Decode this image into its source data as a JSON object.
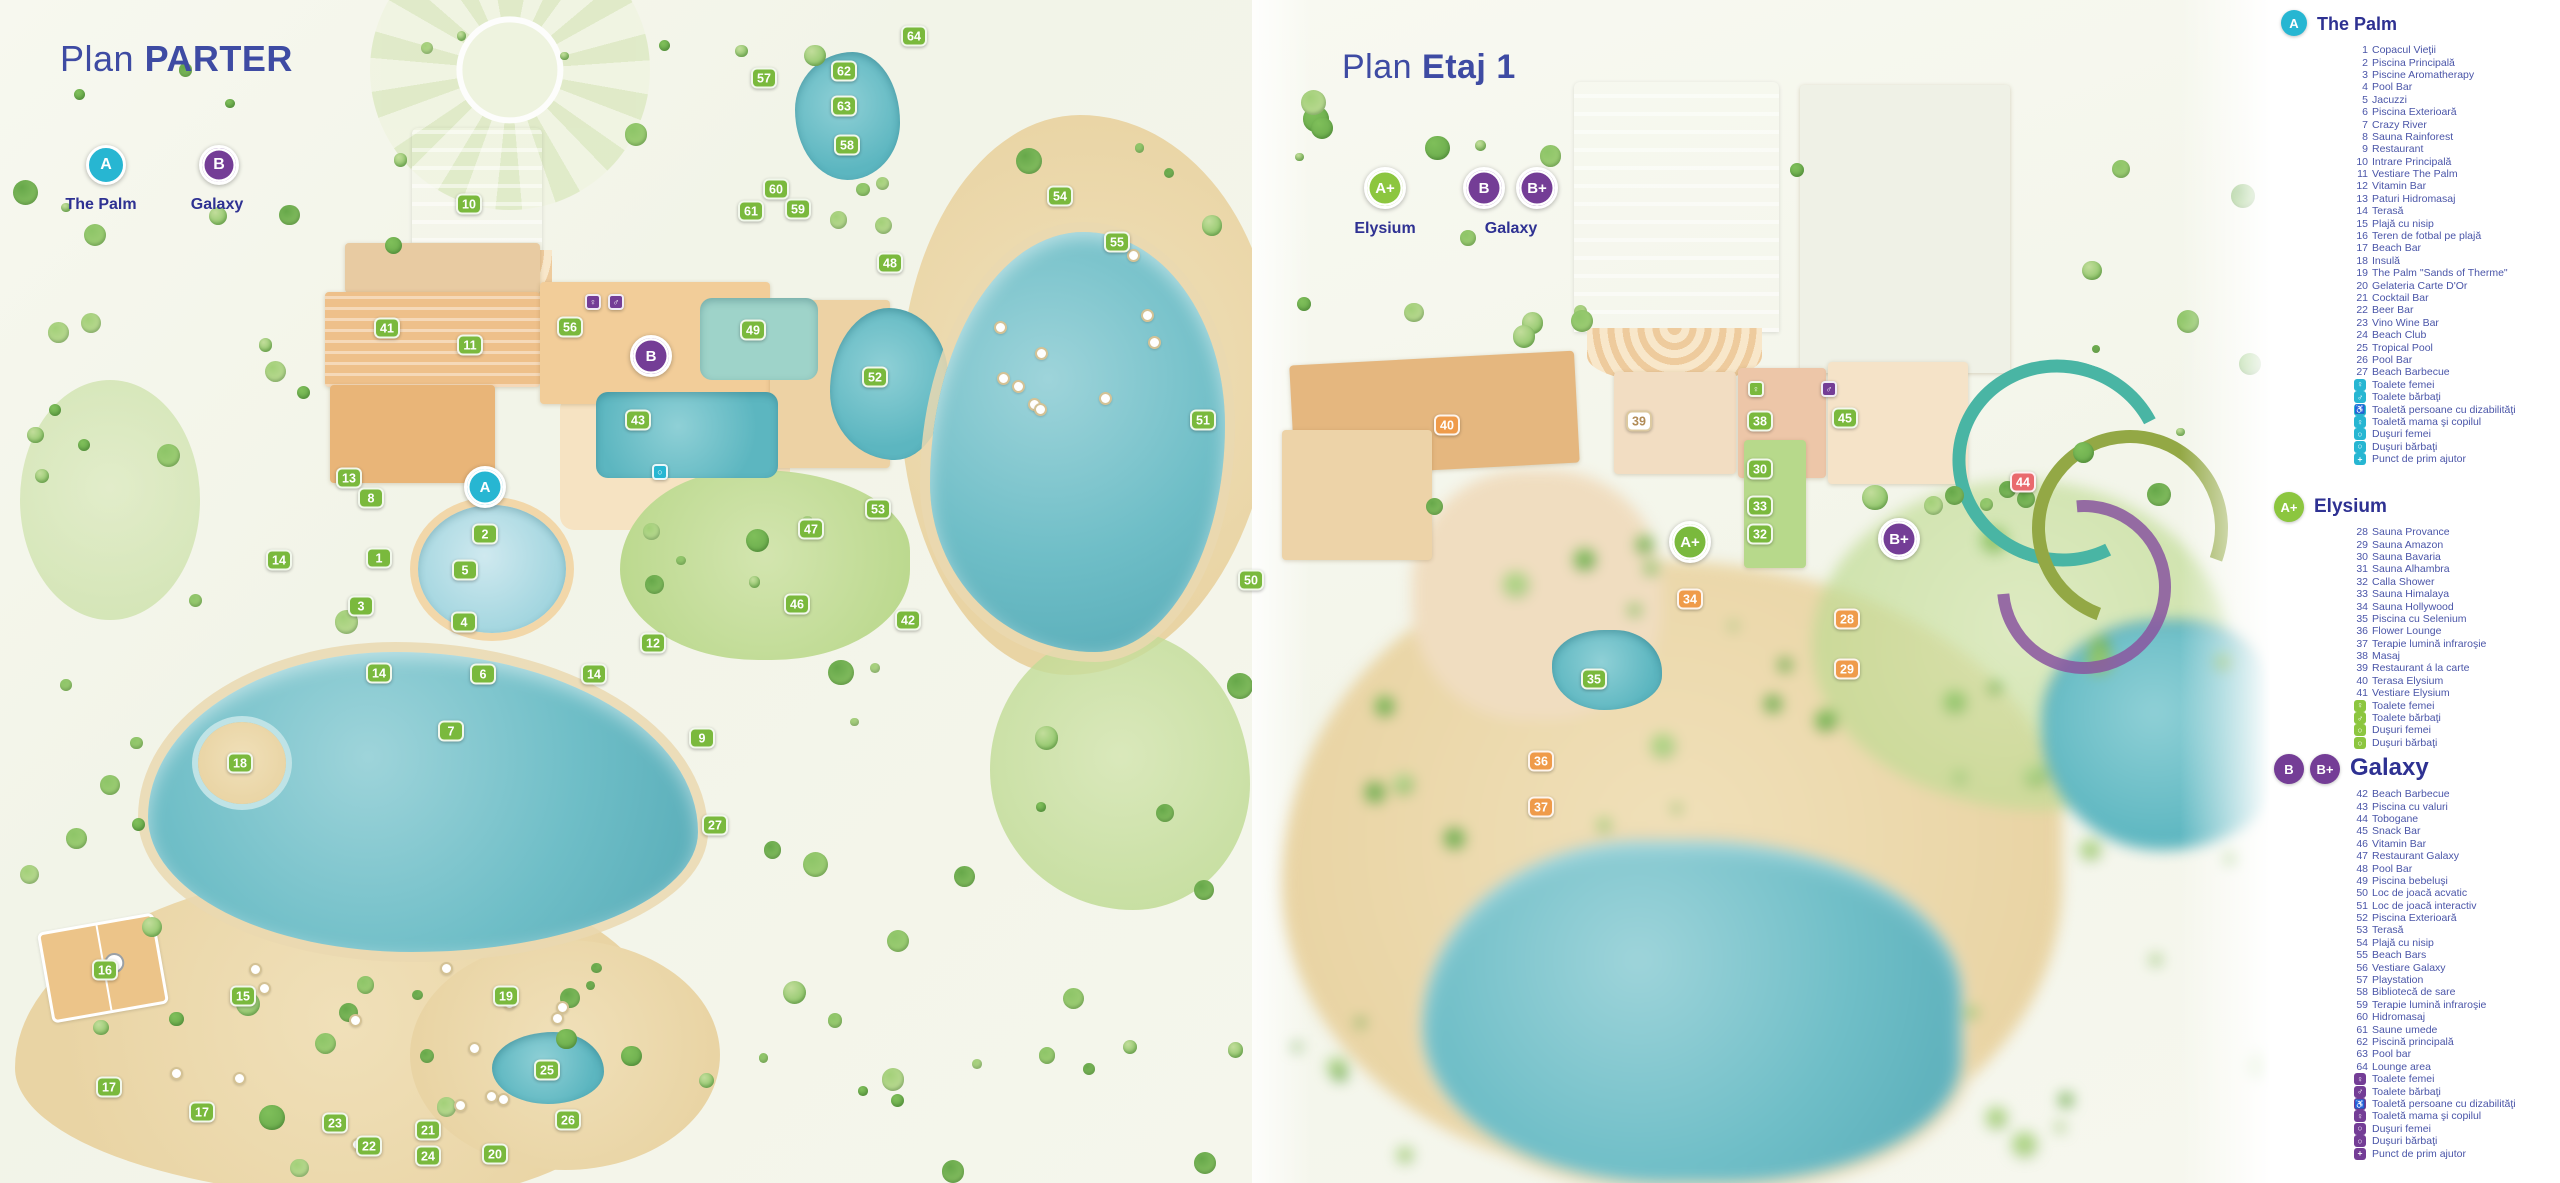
{
  "colors": {
    "cyan": "#27b6d2",
    "green": "#8cc63f",
    "purple": "#743d96",
    "navy": "#2e3192",
    "item_blue": "#4a55a8",
    "marker": {
      "g": "#7ab93d",
      "p": "#743d96",
      "t": "#27b6d2",
      "o": "#ef9b4a",
      "r": "#e96a6e",
      "w": "#ffffff"
    }
  },
  "left_panel": {
    "title_regular": "Plan",
    "title_bold": "PARTER",
    "zone_badges": [
      {
        "letter": "A",
        "label": "The Palm",
        "color": "cyan"
      },
      {
        "letter": "B",
        "label": "Galaxy",
        "color": "purple"
      }
    ],
    "markers": [
      {
        "n": "64",
        "x": 914,
        "y": 36
      },
      {
        "n": "57",
        "x": 764,
        "y": 78
      },
      {
        "n": "62",
        "x": 844,
        "y": 71
      },
      {
        "n": "63",
        "x": 844,
        "y": 106
      },
      {
        "n": "58",
        "x": 847,
        "y": 145
      },
      {
        "n": "10",
        "x": 469,
        "y": 204
      },
      {
        "n": "60",
        "x": 776,
        "y": 189
      },
      {
        "n": "61",
        "x": 751,
        "y": 211
      },
      {
        "n": "59",
        "x": 798,
        "y": 209
      },
      {
        "n": "54",
        "x": 1060,
        "y": 196
      },
      {
        "n": "55",
        "x": 1117,
        "y": 242
      },
      {
        "n": "48",
        "x": 890,
        "y": 263
      },
      {
        "n": "41",
        "x": 387,
        "y": 328
      },
      {
        "n": "11",
        "x": 470,
        "y": 345
      },
      {
        "n": "56",
        "x": 570,
        "y": 327
      },
      {
        "n": "49",
        "x": 753,
        "y": 330
      },
      {
        "n": "A",
        "x": 485,
        "y": 487,
        "c": "t",
        "zone": true
      },
      {
        "n": "B",
        "x": 651,
        "y": 356,
        "c": "p",
        "zone": true
      },
      {
        "n": "52",
        "x": 875,
        "y": 377
      },
      {
        "n": "43",
        "x": 638,
        "y": 420
      },
      {
        "n": "51",
        "x": 1203,
        "y": 420
      },
      {
        "n": "13",
        "x": 349,
        "y": 478
      },
      {
        "n": "8",
        "x": 371,
        "y": 498
      },
      {
        "n": "2",
        "x": 485,
        "y": 534
      },
      {
        "n": "53",
        "x": 878,
        "y": 509
      },
      {
        "n": "47",
        "x": 811,
        "y": 529
      },
      {
        "n": "14",
        "x": 279,
        "y": 560
      },
      {
        "n": "1",
        "x": 379,
        "y": 558
      },
      {
        "n": "5",
        "x": 465,
        "y": 570
      },
      {
        "n": "50",
        "x": 1251,
        "y": 580
      },
      {
        "n": "3",
        "x": 361,
        "y": 606
      },
      {
        "n": "46",
        "x": 797,
        "y": 604
      },
      {
        "n": "4",
        "x": 464,
        "y": 622
      },
      {
        "n": "42",
        "x": 908,
        "y": 620
      },
      {
        "n": "12",
        "x": 653,
        "y": 643
      },
      {
        "n": "14",
        "x": 379,
        "y": 673
      },
      {
        "n": "6",
        "x": 483,
        "y": 674
      },
      {
        "n": "14",
        "x": 594,
        "y": 674
      },
      {
        "n": "7",
        "x": 451,
        "y": 731
      },
      {
        "n": "9",
        "x": 702,
        "y": 738
      },
      {
        "n": "18",
        "x": 240,
        "y": 763
      },
      {
        "n": "27",
        "x": 715,
        "y": 825
      },
      {
        "n": "16",
        "x": 105,
        "y": 970
      },
      {
        "n": "15",
        "x": 243,
        "y": 996
      },
      {
        "n": "19",
        "x": 506,
        "y": 996
      },
      {
        "n": "25",
        "x": 547,
        "y": 1070
      },
      {
        "n": "17",
        "x": 109,
        "y": 1087
      },
      {
        "n": "17",
        "x": 202,
        "y": 1112
      },
      {
        "n": "23",
        "x": 335,
        "y": 1123
      },
      {
        "n": "26",
        "x": 568,
        "y": 1120
      },
      {
        "n": "22",
        "x": 369,
        "y": 1146
      },
      {
        "n": "21",
        "x": 428,
        "y": 1130
      },
      {
        "n": "24",
        "x": 428,
        "y": 1156
      },
      {
        "n": "20",
        "x": 495,
        "y": 1154
      },
      {
        "n": "♀",
        "x": 593,
        "y": 302,
        "c": "p",
        "icon": true
      },
      {
        "n": "♂",
        "x": 616,
        "y": 302,
        "c": "p",
        "icon": true
      },
      {
        "n": "○",
        "x": 660,
        "y": 472,
        "c": "t",
        "icon": true
      }
    ]
  },
  "right_panel": {
    "title_regular": "Plan",
    "title_bold": "Etaj 1",
    "zone_badges": [
      {
        "letter": "A+",
        "label": "Elysium",
        "color": "green"
      },
      {
        "letter": "B",
        "color": "purple"
      },
      {
        "letter": "B+",
        "label": "Galaxy",
        "color": "purple"
      }
    ],
    "markers": [
      {
        "n": "40",
        "x": 1447,
        "y": 425,
        "c": "o"
      },
      {
        "n": "39",
        "x": 1639,
        "y": 421,
        "c": "w"
      },
      {
        "n": "38",
        "x": 1760,
        "y": 421,
        "c": "g"
      },
      {
        "n": "45",
        "x": 1845,
        "y": 418,
        "c": "g"
      },
      {
        "n": "30",
        "x": 1760,
        "y": 469,
        "c": "g"
      },
      {
        "n": "33",
        "x": 1760,
        "y": 506,
        "c": "g"
      },
      {
        "n": "44",
        "x": 2023,
        "y": 482,
        "c": "r"
      },
      {
        "n": "32",
        "x": 1760,
        "y": 534,
        "c": "g"
      },
      {
        "n": "A+",
        "x": 1690,
        "y": 542,
        "c": "g",
        "zone": true
      },
      {
        "n": "B+",
        "x": 1899,
        "y": 539,
        "c": "p",
        "zone": true
      },
      {
        "n": "34",
        "x": 1690,
        "y": 599,
        "c": "o"
      },
      {
        "n": "28",
        "x": 1847,
        "y": 619,
        "c": "o"
      },
      {
        "n": "29",
        "x": 1847,
        "y": 669,
        "c": "o"
      },
      {
        "n": "35",
        "x": 1594,
        "y": 679,
        "c": "g"
      },
      {
        "n": "36",
        "x": 1541,
        "y": 761,
        "c": "o"
      },
      {
        "n": "37",
        "x": 1541,
        "y": 807,
        "c": "o"
      },
      {
        "n": "♀",
        "x": 1756,
        "y": 389,
        "c": "g",
        "icon": true
      },
      {
        "n": "♂",
        "x": 1829,
        "y": 389,
        "c": "p",
        "icon": true
      }
    ]
  },
  "legend": {
    "sections": [
      {
        "id": "palm",
        "title": "The Palm",
        "accent": "#27b6d2",
        "badges": [
          {
            "letter": "A",
            "color": "#27b6d2",
            "ring": false
          }
        ],
        "items": [
          {
            "n": "1",
            "label": "Copacul Vieţii"
          },
          {
            "n": "2",
            "label": "Piscina Principală"
          },
          {
            "n": "3",
            "label": "Piscine Aromatherapy"
          },
          {
            "n": "4",
            "label": "Pool Bar"
          },
          {
            "n": "5",
            "label": "Jacuzzi"
          },
          {
            "n": "6",
            "label": "Piscina Exterioară"
          },
          {
            "n": "7",
            "label": "Crazy River"
          },
          {
            "n": "8",
            "label": "Sauna Rainforest"
          },
          {
            "n": "9",
            "label": "Restaurant"
          },
          {
            "n": "10",
            "label": "Intrare Principală"
          },
          {
            "n": "11",
            "label": "Vestiare The Palm"
          },
          {
            "n": "12",
            "label": "Vitamin Bar"
          },
          {
            "n": "13",
            "label": "Paturi Hidromasaj"
          },
          {
            "n": "14",
            "label": "Terasă"
          },
          {
            "n": "15",
            "label": "Plajă cu nisip"
          },
          {
            "n": "16",
            "label": "Teren de fotbal pe plajă"
          },
          {
            "n": "17",
            "label": "Beach Bar"
          },
          {
            "n": "18",
            "label": "Insulă"
          },
          {
            "n": "19",
            "label": "The Palm \"Sands of Therme\""
          },
          {
            "n": "20",
            "label": "Gelateria Carte D'Or"
          },
          {
            "n": "21",
            "label": "Cocktail Bar"
          },
          {
            "n": "22",
            "label": "Beer Bar"
          },
          {
            "n": "23",
            "label": "Vino Wine Bar"
          },
          {
            "n": "24",
            "label": "Beach Club"
          },
          {
            "n": "25",
            "label": "Tropical Pool"
          },
          {
            "n": "26",
            "label": "Pool Bar"
          },
          {
            "n": "27",
            "label": "Beach Barbecue"
          }
        ],
        "icons": [
          {
            "glyph": "♀",
            "name": "toilet-women-icon",
            "label": "Toalete femei"
          },
          {
            "glyph": "♂",
            "name": "toilet-men-icon",
            "label": "Toalete bărbaţi"
          },
          {
            "glyph": "♿",
            "name": "toilet-disabled-icon",
            "label": "Toaletă persoane cu dizabilităţi"
          },
          {
            "glyph": "♀",
            "name": "toilet-mother-child-icon",
            "label": "Toaletă mama şi copilul"
          },
          {
            "glyph": "○",
            "name": "shower-women-icon",
            "label": "Duşuri femei"
          },
          {
            "glyph": "○",
            "name": "shower-men-icon",
            "label": "Duşuri bărbaţi"
          },
          {
            "glyph": "+",
            "name": "first-aid-icon",
            "label": "Punct de prim ajutor"
          }
        ]
      },
      {
        "id": "elysium",
        "title": "Elysium",
        "accent": "#8cc63f",
        "badges": [
          {
            "letter": "A+",
            "color": "#8cc63f",
            "ring": true
          }
        ],
        "items": [
          {
            "n": "28",
            "label": "Sauna Provance"
          },
          {
            "n": "29",
            "label": "Sauna Amazon"
          },
          {
            "n": "30",
            "label": "Sauna Bavaria"
          },
          {
            "n": "31",
            "label": "Sauna Alhambra"
          },
          {
            "n": "32",
            "label": "Calla Shower"
          },
          {
            "n": "33",
            "label": "Sauna Himalaya"
          },
          {
            "n": "34",
            "label": "Sauna Hollywood"
          },
          {
            "n": "35",
            "label": "Piscina cu Selenium"
          },
          {
            "n": "36",
            "label": "Flower Lounge"
          },
          {
            "n": "37",
            "label": "Terapie lumină infraroşie"
          },
          {
            "n": "38",
            "label": "Masaj"
          },
          {
            "n": "39",
            "label": "Restaurant á la carte"
          },
          {
            "n": "40",
            "label": "Terasa Elysium"
          },
          {
            "n": "41",
            "label": "Vestiare Elysium"
          }
        ],
        "icons": [
          {
            "glyph": "♀",
            "name": "toilet-women-icon",
            "label": "Toalete femei"
          },
          {
            "glyph": "♂",
            "name": "toilet-men-icon",
            "label": "Toalete bărbaţi"
          },
          {
            "glyph": "○",
            "name": "shower-women-icon",
            "label": "Duşuri femei"
          },
          {
            "glyph": "○",
            "name": "shower-men-icon",
            "label": "Duşuri bărbaţi"
          }
        ]
      },
      {
        "id": "galaxy",
        "title": "Galaxy",
        "accent": "#743d96",
        "badges": [
          {
            "letter": "B",
            "color": "#743d96",
            "ring": true
          },
          {
            "letter": "B+",
            "color": "#743d96",
            "ring": true
          }
        ],
        "items": [
          {
            "n": "42",
            "label": "Beach Barbecue"
          },
          {
            "n": "43",
            "label": "Piscina cu valuri"
          },
          {
            "n": "44",
            "label": "Tobogane"
          },
          {
            "n": "45",
            "label": "Snack Bar"
          },
          {
            "n": "46",
            "label": "Vitamin Bar"
          },
          {
            "n": "47",
            "label": "Restaurant Galaxy"
          },
          {
            "n": "48",
            "label": "Pool Bar"
          },
          {
            "n": "49",
            "label": "Piscina bebeluşi"
          },
          {
            "n": "50",
            "label": "Loc de joacă acvatic"
          },
          {
            "n": "51",
            "label": "Loc de joacă interactiv"
          },
          {
            "n": "52",
            "label": "Piscina Exterioară"
          },
          {
            "n": "53",
            "label": "Terasă"
          },
          {
            "n": "54",
            "label": "Plajă cu nisip"
          },
          {
            "n": "55",
            "label": "Beach Bars"
          },
          {
            "n": "56",
            "label": "Vestiare Galaxy"
          },
          {
            "n": "57",
            "label": "Playstation"
          },
          {
            "n": "58",
            "label": "Bibliotecă de sare"
          },
          {
            "n": "59",
            "label": "Terapie lumină infraroşie"
          },
          {
            "n": "60",
            "label": "Hidromasaj"
          },
          {
            "n": "61",
            "label": "Saune umede"
          },
          {
            "n": "62",
            "label": "Piscină principală"
          },
          {
            "n": "63",
            "label": "Pool bar"
          },
          {
            "n": "64",
            "label": "Lounge area"
          }
        ],
        "icons": [
          {
            "glyph": "♀",
            "name": "toilet-women-icon",
            "label": "Toalete femei"
          },
          {
            "glyph": "♂",
            "name": "toilet-men-icon",
            "label": "Toalete bărbaţi"
          },
          {
            "glyph": "♿",
            "name": "toilet-disabled-icon",
            "label": "Toaletă persoane cu dizabilităţi"
          },
          {
            "glyph": "♀",
            "name": "toilet-mother-child-icon",
            "label": "Toaletă mama şi copilul"
          },
          {
            "glyph": "○",
            "name": "shower-women-icon",
            "label": "Duşuri femei"
          },
          {
            "glyph": "○",
            "name": "shower-men-icon",
            "label": "Duşuri bărbaţi"
          },
          {
            "glyph": "+",
            "name": "first-aid-icon",
            "label": "Punct de prim ajutor"
          }
        ]
      }
    ]
  }
}
